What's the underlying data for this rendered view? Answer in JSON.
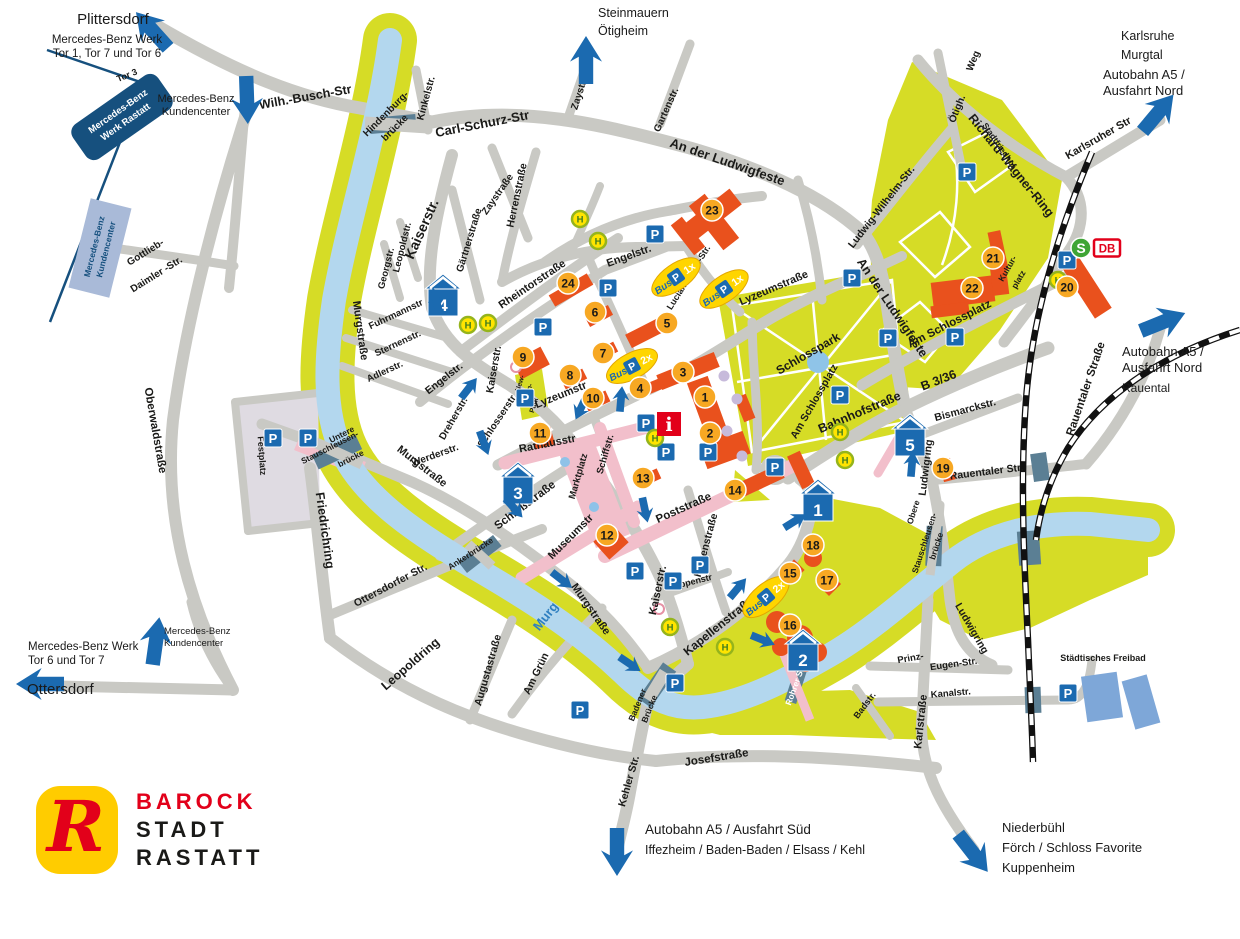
{
  "logo": {
    "mark": "R",
    "line1": "BAROCK",
    "line2": "STADT",
    "line3": "RASTATT"
  },
  "colors": {
    "road": "#c9c9c4",
    "park": "#d6dc26",
    "river": "#b3d7ee",
    "building": "#e9511d",
    "marker": "#f7a823",
    "blue": "#1b6ab0",
    "pink": "#f2bfcb",
    "navy": "#16507e",
    "freibad": "#7ea7d8",
    "red": "#e2001a",
    "hfill": "#ffe400",
    "hring": "#95b41c",
    "hletter": "#3e7c1f",
    "slate": "#5b7f94",
    "plaza": "#dfdbe2",
    "pond": "#8fc4e8"
  },
  "icon_labels": {
    "parking": "P",
    "bus_stop": "H",
    "bus": "Bus",
    "info": "i",
    "sbahn": "S",
    "db": "DB"
  },
  "mercedes": {
    "plant_line1": "Mercedes-Benz",
    "plant_line2": "Werk Rastatt",
    "customer_line1": "Mercedes-Benz",
    "customer_line2": "Kundencenter"
  },
  "destinations": [
    {
      "id": "plittersdorf",
      "lines": [
        {
          "t": "Plittersdorf",
          "x": 113,
          "y": 24,
          "s": 15,
          "a": "middle"
        },
        {
          "t": "Mercedes-Benz Werk",
          "x": 107,
          "y": 43,
          "s": 11.5,
          "a": "middle"
        },
        {
          "t": "Tor 1, Tor 7 und Tor 6",
          "x": 107,
          "y": 57,
          "s": 11.5,
          "a": "middle"
        }
      ]
    },
    {
      "id": "kundencenter-top",
      "lines": [
        {
          "t": "Mercedes-Benz",
          "x": 196,
          "y": 102,
          "s": 11,
          "a": "middle"
        },
        {
          "t": "Kundencenter",
          "x": 196,
          "y": 115,
          "s": 11,
          "a": "middle"
        }
      ]
    },
    {
      "id": "steinmauern",
      "lines": [
        {
          "t": "Steinmauern",
          "x": 598,
          "y": 17,
          "s": 12.5,
          "a": "start"
        },
        {
          "t": "Ötigheim",
          "x": 598,
          "y": 35,
          "s": 12.5,
          "a": "start"
        }
      ]
    },
    {
      "id": "karlsruhe",
      "lines": [
        {
          "t": "Karlsruhe",
          "x": 1121,
          "y": 40,
          "s": 12.5,
          "a": "start"
        },
        {
          "t": "Murgtal",
          "x": 1121,
          "y": 59,
          "s": 12.5,
          "a": "start"
        },
        {
          "t": "Autobahn A5 /",
          "x": 1103,
          "y": 79,
          "s": 13,
          "a": "start"
        },
        {
          "t": "Ausfahrt Nord",
          "x": 1103,
          "y": 95,
          "s": 13,
          "a": "start"
        }
      ]
    },
    {
      "id": "autobahn-nord-rauental",
      "lines": [
        {
          "t": "Autobahn A5 /",
          "x": 1122,
          "y": 356,
          "s": 13,
          "a": "start"
        },
        {
          "t": "Ausfahrt Nord",
          "x": 1122,
          "y": 372,
          "s": 13,
          "a": "start"
        },
        {
          "t": "Rauental",
          "x": 1122,
          "y": 392,
          "s": 12,
          "a": "start"
        }
      ]
    },
    {
      "id": "mb-werk-bottom",
      "lines": [
        {
          "t": "Mercedes-Benz Werk",
          "x": 28,
          "y": 650,
          "s": 11.5,
          "a": "start"
        },
        {
          "t": "Tor 6 und Tor 7",
          "x": 28,
          "y": 664,
          "s": 11.5,
          "a": "start"
        },
        {
          "t": "Ottersdorf",
          "x": 27,
          "y": 694,
          "s": 15,
          "a": "start"
        }
      ]
    },
    {
      "id": "kundencenter-bottom",
      "lines": [
        {
          "t": "Mercedes-Benz",
          "x": 164,
          "y": 634,
          "s": 9.5,
          "a": "start"
        },
        {
          "t": "Kundencenter",
          "x": 164,
          "y": 646,
          "s": 9.5,
          "a": "start"
        }
      ]
    },
    {
      "id": "autobahn-sued",
      "lines": [
        {
          "t": "Autobahn A5 / Ausfahrt Süd",
          "x": 645,
          "y": 834,
          "s": 13.5,
          "a": "start"
        },
        {
          "t": "Iffezheim / Baden-Baden / Elsass / Kehl",
          "x": 645,
          "y": 854,
          "s": 12.5,
          "a": "start"
        }
      ]
    },
    {
      "id": "niederbuehl",
      "lines": [
        {
          "t": "Niederbühl",
          "x": 1002,
          "y": 832,
          "s": 13,
          "a": "start"
        },
        {
          "t": "Förch / Schloss Favorite",
          "x": 1002,
          "y": 852,
          "s": 13,
          "a": "start"
        },
        {
          "t": "Kuppenheim",
          "x": 1002,
          "y": 872,
          "s": 13,
          "a": "start"
        }
      ]
    }
  ],
  "street_labels": [
    {
      "t": "Wilh.-Busch-Str",
      "x": 306,
      "y": 101,
      "r": -10,
      "s": 12.5
    },
    {
      "t": "Hindenburg-",
      "x": 388,
      "y": 116,
      "r": -45,
      "s": 10
    },
    {
      "t": "brücke",
      "x": 397,
      "y": 130,
      "r": -45,
      "s": 10
    },
    {
      "t": "Kinkelstr.",
      "x": 429,
      "y": 99,
      "r": -75,
      "s": 10
    },
    {
      "t": "Carl-Schurz-Str",
      "x": 483,
      "y": 128,
      "r": -11,
      "s": 13
    },
    {
      "t": "Zaystr.",
      "x": 582,
      "y": 95,
      "r": -72,
      "s": 10
    },
    {
      "t": "Zaystraße",
      "x": 500,
      "y": 196,
      "r": -55,
      "s": 10
    },
    {
      "t": "Gartenstr.",
      "x": 669,
      "y": 111,
      "r": -66,
      "s": 10
    },
    {
      "t": "An der Ludwigfeste",
      "x": 726,
      "y": 166,
      "r": 19,
      "s": 13
    },
    {
      "t": "Ötigh.",
      "x": 960,
      "y": 110,
      "r": -68,
      "s": 10
    },
    {
      "t": "Weg",
      "x": 976,
      "y": 62,
      "r": -68,
      "s": 10
    },
    {
      "t": "Richard-Wagner-Ring",
      "x": 1008,
      "y": 168,
      "r": 51,
      "s": 12.5
    },
    {
      "t": "Stadtfriedhof",
      "x": 997,
      "y": 147,
      "r": 55,
      "s": 8.5
    },
    {
      "t": "Karlsruher Str",
      "x": 1100,
      "y": 141,
      "r": -30,
      "s": 11
    },
    {
      "t": "Ludwig-Wilhelm-Str.",
      "x": 884,
      "y": 209,
      "r": -52,
      "s": 10.5
    },
    {
      "t": "An der Ludwigfeste",
      "x": 889,
      "y": 310,
      "r": 56,
      "s": 12.5
    },
    {
      "t": "Kaiserstr.",
      "x": 426,
      "y": 231,
      "r": -66,
      "s": 14
    },
    {
      "t": "Leopoldstr.",
      "x": 405,
      "y": 248,
      "r": -76,
      "s": 9.5
    },
    {
      "t": "Georgstr.",
      "x": 389,
      "y": 269,
      "r": -76,
      "s": 9.5
    },
    {
      "t": "Gärtnerstraße",
      "x": 472,
      "y": 241,
      "r": -73,
      "s": 10
    },
    {
      "t": "Herrenstraße",
      "x": 520,
      "y": 196,
      "r": -78,
      "s": 10.5
    },
    {
      "t": "Rheintorstraße",
      "x": 534,
      "y": 287,
      "r": -34,
      "s": 11
    },
    {
      "t": "Fuhrmannstr",
      "x": 397,
      "y": 317,
      "r": -25,
      "s": 9.5
    },
    {
      "t": "Sternenstr.",
      "x": 399,
      "y": 346,
      "r": -25,
      "s": 9.5
    },
    {
      "t": "Adlerstr.",
      "x": 386,
      "y": 374,
      "r": -25,
      "s": 9.5
    },
    {
      "t": "Murgstraße",
      "x": 357,
      "y": 331,
      "r": 82,
      "s": 11
    },
    {
      "t": "Murgstraße",
      "x": 420,
      "y": 469,
      "r": 38,
      "s": 11
    },
    {
      "t": "Murgstraße",
      "x": 588,
      "y": 611,
      "r": 55,
      "s": 11
    },
    {
      "t": "Oberwaldstraße",
      "x": 152,
      "y": 431,
      "r": 80,
      "s": 11.5
    },
    {
      "t": "Friedrichring",
      "x": 321,
      "y": 531,
      "r": 82,
      "s": 12.5
    },
    {
      "t": "Festplatz",
      "x": 259,
      "y": 456,
      "r": 86,
      "s": 9
    },
    {
      "t": "Untere",
      "x": 343,
      "y": 437,
      "r": -27,
      "s": 8.5
    },
    {
      "t": "Stauschleusen-",
      "x": 331,
      "y": 450,
      "r": -27,
      "s": 8.5
    },
    {
      "t": "brücke",
      "x": 352,
      "y": 461,
      "r": -27,
      "s": 8.5
    },
    {
      "t": "Engelstr.",
      "x": 446,
      "y": 381,
      "r": -38,
      "s": 10.5
    },
    {
      "t": "Engelstr.",
      "x": 630,
      "y": 259,
      "r": -20,
      "s": 11
    },
    {
      "t": "Lucian-Reich-Str.",
      "x": 691,
      "y": 279,
      "r": -58,
      "s": 9
    },
    {
      "t": "Lyzeumstraße",
      "x": 775,
      "y": 291,
      "r": -23,
      "s": 11
    },
    {
      "t": "Lyzeumstr",
      "x": 562,
      "y": 398,
      "r": -22,
      "s": 11
    },
    {
      "t": "Kaiserstr.",
      "x": 497,
      "y": 370,
      "r": -80,
      "s": 10.5
    },
    {
      "t": "Kaiserstr.",
      "x": 661,
      "y": 591,
      "r": -78,
      "s": 11
    },
    {
      "t": "Schlosserstr.",
      "x": 500,
      "y": 422,
      "r": -56,
      "s": 10
    },
    {
      "t": "Dreherstr.",
      "x": 456,
      "y": 420,
      "r": -60,
      "s": 10
    },
    {
      "t": "Werderstr.",
      "x": 436,
      "y": 458,
      "r": -20,
      "s": 10
    },
    {
      "t": "Rathausstr",
      "x": 548,
      "y": 447,
      "r": -11,
      "s": 11
    },
    {
      "t": "Marktplatz",
      "x": 581,
      "y": 477,
      "r": -74,
      "s": 9.5
    },
    {
      "t": "Schiffstr.",
      "x": 608,
      "y": 455,
      "r": -74,
      "s": 9.5
    },
    {
      "t": "Schloßstraße",
      "x": 527,
      "y": 508,
      "r": -37,
      "s": 11.5
    },
    {
      "t": "Museumstr",
      "x": 573,
      "y": 539,
      "r": -45,
      "s": 11
    },
    {
      "t": "Poststraße",
      "x": 685,
      "y": 511,
      "r": -24,
      "s": 11.5
    },
    {
      "t": "Herrenstraße",
      "x": 709,
      "y": 546,
      "r": -75,
      "s": 10.5
    },
    {
      "t": "Rappenstr",
      "x": 691,
      "y": 585,
      "r": -14,
      "s": 9
    },
    {
      "t": "Kapellenstraße",
      "x": 721,
      "y": 629,
      "r": -39,
      "s": 12
    },
    {
      "t": "Rohrer Steg",
      "x": 799,
      "y": 683,
      "r": -70,
      "s": 8.5,
      "c": "#ffffff"
    },
    {
      "t": "Bahnhofstraße",
      "x": 861,
      "y": 416,
      "r": -23,
      "s": 12.5
    },
    {
      "t": "B 3/36",
      "x": 940,
      "y": 384,
      "r": -21,
      "s": 12.5
    },
    {
      "t": "Am Schlossplatz",
      "x": 951,
      "y": 327,
      "r": -27,
      "s": 11.5
    },
    {
      "t": "Am Schlossplatz",
      "x": 817,
      "y": 403,
      "r": -60,
      "s": 10.5
    },
    {
      "t": "Kultur-",
      "x": 1010,
      "y": 270,
      "r": -60,
      "s": 8.5
    },
    {
      "t": "platz",
      "x": 1021,
      "y": 281,
      "r": -60,
      "s": 8.5
    },
    {
      "t": "Bismarckstr.",
      "x": 966,
      "y": 413,
      "r": -15,
      "s": 10.5
    },
    {
      "t": "Ludwigring",
      "x": 929,
      "y": 468,
      "r": -83,
      "s": 10.5
    },
    {
      "t": "Ludwigring",
      "x": 969,
      "y": 630,
      "r": 60,
      "s": 10.5
    },
    {
      "t": "Rauentaler Str.",
      "x": 987,
      "y": 475,
      "r": -7,
      "s": 10.5
    },
    {
      "t": "Rauentaler Straße",
      "x": 1089,
      "y": 390,
      "r": -71,
      "s": 11.5
    },
    {
      "t": "Obere",
      "x": 916,
      "y": 513,
      "r": -72,
      "s": 8.5
    },
    {
      "t": "Stauschleusen-",
      "x": 927,
      "y": 544,
      "r": -72,
      "s": 8.5
    },
    {
      "t": "brücke",
      "x": 939,
      "y": 547,
      "r": -72,
      "s": 8.5
    },
    {
      "t": "Prinz-",
      "x": 911,
      "y": 661,
      "r": -10,
      "s": 9.5
    },
    {
      "t": "Eugen-Str.",
      "x": 954,
      "y": 667,
      "r": -8,
      "s": 9.5
    },
    {
      "t": "Kanalstr.",
      "x": 951,
      "y": 696,
      "r": -5,
      "s": 9.5
    },
    {
      "t": "Badstr.",
      "x": 867,
      "y": 707,
      "r": -53,
      "s": 9
    },
    {
      "t": "Karlstraße",
      "x": 924,
      "y": 722,
      "r": -84,
      "s": 11
    },
    {
      "t": "Josefstraße",
      "x": 717,
      "y": 761,
      "r": -9,
      "s": 11.5
    },
    {
      "t": "Kehler Str.",
      "x": 632,
      "y": 782,
      "r": -74,
      "s": 10.5
    },
    {
      "t": "Badener",
      "x": 640,
      "y": 706,
      "r": -68,
      "s": 8.5
    },
    {
      "t": "Brücke",
      "x": 652,
      "y": 710,
      "r": -68,
      "s": 8.5
    },
    {
      "t": "Ankerbrücke",
      "x": 472,
      "y": 556,
      "r": -33,
      "s": 8.5
    },
    {
      "t": "Ottersdorfer Str.",
      "x": 392,
      "y": 588,
      "r": -28,
      "s": 10.5
    },
    {
      "t": "Leopoldring",
      "x": 413,
      "y": 667,
      "r": -41,
      "s": 12.5
    },
    {
      "t": "Augustastraße",
      "x": 491,
      "y": 671,
      "r": -74,
      "s": 10.5
    },
    {
      "t": "Am Grün",
      "x": 539,
      "y": 675,
      "r": -64,
      "s": 10.5
    },
    {
      "t": "Murg",
      "x": 549,
      "y": 619,
      "r": -52,
      "s": 13,
      "c": "#2e7fc0"
    },
    {
      "t": "Gottlieb-",
      "x": 147,
      "y": 255,
      "r": -32,
      "s": 10
    },
    {
      "t": "Daimler -Str.",
      "x": 158,
      "y": 277,
      "r": -32,
      "s": 10
    },
    {
      "t": "New-",
      "x": 522,
      "y": 384,
      "r": -72,
      "s": 7
    },
    {
      "t": "Britain-",
      "x": 529,
      "y": 396,
      "r": -72,
      "s": 7
    },
    {
      "t": "Park",
      "x": 536,
      "y": 406,
      "r": -72,
      "s": 7
    },
    {
      "t": "Schlosspark",
      "x": 810,
      "y": 357,
      "r": -30,
      "s": 12
    },
    {
      "t": "Tor 3",
      "x": 128,
      "y": 78,
      "r": -22,
      "s": 9
    },
    {
      "t": "Städtisches Freibad",
      "x": 1103,
      "y": 661,
      "r": 0,
      "s": 9
    }
  ],
  "markers": [
    {
      "n": "1",
      "x": 705,
      "y": 397
    },
    {
      "n": "2",
      "x": 710,
      "y": 433
    },
    {
      "n": "3",
      "x": 683,
      "y": 372
    },
    {
      "n": "4",
      "x": 640,
      "y": 388
    },
    {
      "n": "5",
      "x": 667,
      "y": 323
    },
    {
      "n": "6",
      "x": 595,
      "y": 312
    },
    {
      "n": "7",
      "x": 603,
      "y": 353
    },
    {
      "n": "8",
      "x": 570,
      "y": 375
    },
    {
      "n": "9",
      "x": 523,
      "y": 357
    },
    {
      "n": "10",
      "x": 593,
      "y": 398
    },
    {
      "n": "11",
      "x": 540,
      "y": 433
    },
    {
      "n": "12",
      "x": 607,
      "y": 535
    },
    {
      "n": "13",
      "x": 643,
      "y": 478
    },
    {
      "n": "14",
      "x": 735,
      "y": 490
    },
    {
      "n": "15",
      "x": 790,
      "y": 573
    },
    {
      "n": "16",
      "x": 790,
      "y": 625
    },
    {
      "n": "17",
      "x": 827,
      "y": 580
    },
    {
      "n": "18",
      "x": 813,
      "y": 545
    },
    {
      "n": "19",
      "x": 943,
      "y": 468
    },
    {
      "n": "20",
      "x": 1067,
      "y": 287
    },
    {
      "n": "21",
      "x": 993,
      "y": 258
    },
    {
      "n": "22",
      "x": 972,
      "y": 288
    },
    {
      "n": "23",
      "x": 712,
      "y": 210
    },
    {
      "n": "24",
      "x": 568,
      "y": 283
    }
  ],
  "parkhaus": [
    {
      "n": "1",
      "x": 818,
      "y": 502
    },
    {
      "n": "2",
      "x": 803,
      "y": 652
    },
    {
      "n": "3",
      "x": 518,
      "y": 485
    },
    {
      "n": "4",
      "x": 443,
      "y": 297
    },
    {
      "n": "5",
      "x": 910,
      "y": 437
    }
  ],
  "parking_spots": [
    [
      273,
      438
    ],
    [
      308,
      438
    ],
    [
      543,
      327
    ],
    [
      525,
      398
    ],
    [
      608,
      288
    ],
    [
      655,
      234
    ],
    [
      646,
      423
    ],
    [
      666,
      452
    ],
    [
      708,
      452
    ],
    [
      775,
      467
    ],
    [
      635,
      571
    ],
    [
      673,
      581
    ],
    [
      700,
      565
    ],
    [
      675,
      683
    ],
    [
      580,
      710
    ],
    [
      852,
      278
    ],
    [
      888,
      338
    ],
    [
      955,
      337
    ],
    [
      840,
      395
    ],
    [
      967,
      172
    ],
    [
      1067,
      260
    ],
    [
      1068,
      693
    ]
  ],
  "bus_stops": [
    [
      580,
      219
    ],
    [
      598,
      241
    ],
    [
      468,
      325
    ],
    [
      488,
      323
    ],
    [
      655,
      438
    ],
    [
      670,
      627
    ],
    [
      725,
      647
    ],
    [
      840,
      432
    ],
    [
      845,
      460
    ],
    [
      1058,
      280
    ]
  ],
  "bus_parking": [
    {
      "label": "1x",
      "x": 676,
      "y": 277,
      "r": -35
    },
    {
      "label": "1x",
      "x": 724,
      "y": 289,
      "r": -35
    },
    {
      "label": "2x",
      "x": 632,
      "y": 366,
      "r": -28
    },
    {
      "label": "2x",
      "x": 766,
      "y": 597,
      "r": -40
    }
  ],
  "arrows_large": [
    [
      152,
      30,
      -42
    ],
    [
      247,
      100,
      178
    ],
    [
      586,
      60,
      0
    ],
    [
      1158,
      113,
      40
    ],
    [
      1163,
      322,
      68
    ],
    [
      40,
      684,
      -90
    ],
    [
      156,
      641,
      8
    ],
    [
      617,
      852,
      180
    ],
    [
      973,
      853,
      142
    ]
  ],
  "arrows_small": [
    [
      436,
      300,
      -15
    ],
    [
      469,
      388,
      38
    ],
    [
      484,
      443,
      160
    ],
    [
      514,
      508,
      138
    ],
    [
      562,
      580,
      128
    ],
    [
      630,
      664,
      124
    ],
    [
      581,
      408,
      205
    ],
    [
      621,
      399,
      5
    ],
    [
      645,
      510,
      168
    ],
    [
      795,
      521,
      58
    ],
    [
      912,
      464,
      5
    ],
    [
      738,
      588,
      40
    ],
    [
      763,
      640,
      112
    ]
  ],
  "info_icon": {
    "x": 669,
    "y": 424
  },
  "sbahn_icon": {
    "x": 1081,
    "y": 248
  },
  "db_icon": {
    "x": 1107,
    "y": 248
  }
}
